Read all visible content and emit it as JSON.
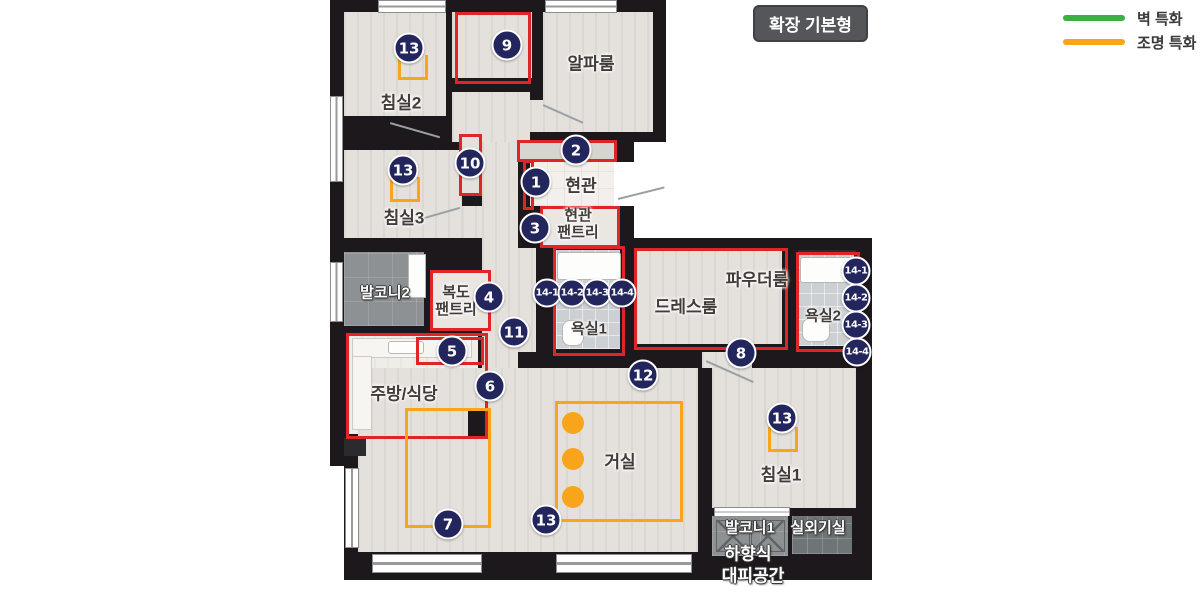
{
  "badge": {
    "label": "확장 기본형"
  },
  "legend": {
    "items": [
      {
        "label": "벽 특화",
        "color": "#3caf46"
      },
      {
        "label": "조명 특화",
        "color": "#f9a51b"
      }
    ]
  },
  "rooms": {
    "bedroom2": {
      "label": "침실2"
    },
    "alpha": {
      "label": "알파룸"
    },
    "entrance": {
      "label": "현관"
    },
    "entrance_pantry": {
      "line1": "현관",
      "line2": "팬트리"
    },
    "bedroom3": {
      "label": "침실3"
    },
    "balcony2": {
      "label": "발코니2"
    },
    "corridor_pantry": {
      "line1": "복도",
      "line2": "팬트리"
    },
    "bath1": {
      "label": "욕실1"
    },
    "dressroom": {
      "label": "드레스룸"
    },
    "powder": {
      "label": "파우더룸"
    },
    "bath2": {
      "label": "욕실2"
    },
    "kitchen": {
      "label": "주방/식당"
    },
    "living": {
      "label": "거실"
    },
    "bedroom1": {
      "label": "침실1"
    },
    "balcony1": {
      "label": "발코니1"
    },
    "outdoor_unit": {
      "label": "실외기실"
    },
    "evac": {
      "line1": "하향식",
      "line2": "대피공간"
    }
  },
  "markers": {
    "labels": [
      "1",
      "2",
      "3",
      "4",
      "5",
      "6",
      "7",
      "8",
      "9",
      "10",
      "11",
      "12",
      "13",
      "13",
      "13",
      "13",
      "14-1",
      "14-2",
      "14-3",
      "14-4",
      "14-1",
      "14-2",
      "14-3",
      "14-4"
    ]
  },
  "colors": {
    "wall_feature": "#3caf46",
    "light_feature": "#f9a51b",
    "feature_box": "#e02528",
    "marker": "#23255d"
  }
}
